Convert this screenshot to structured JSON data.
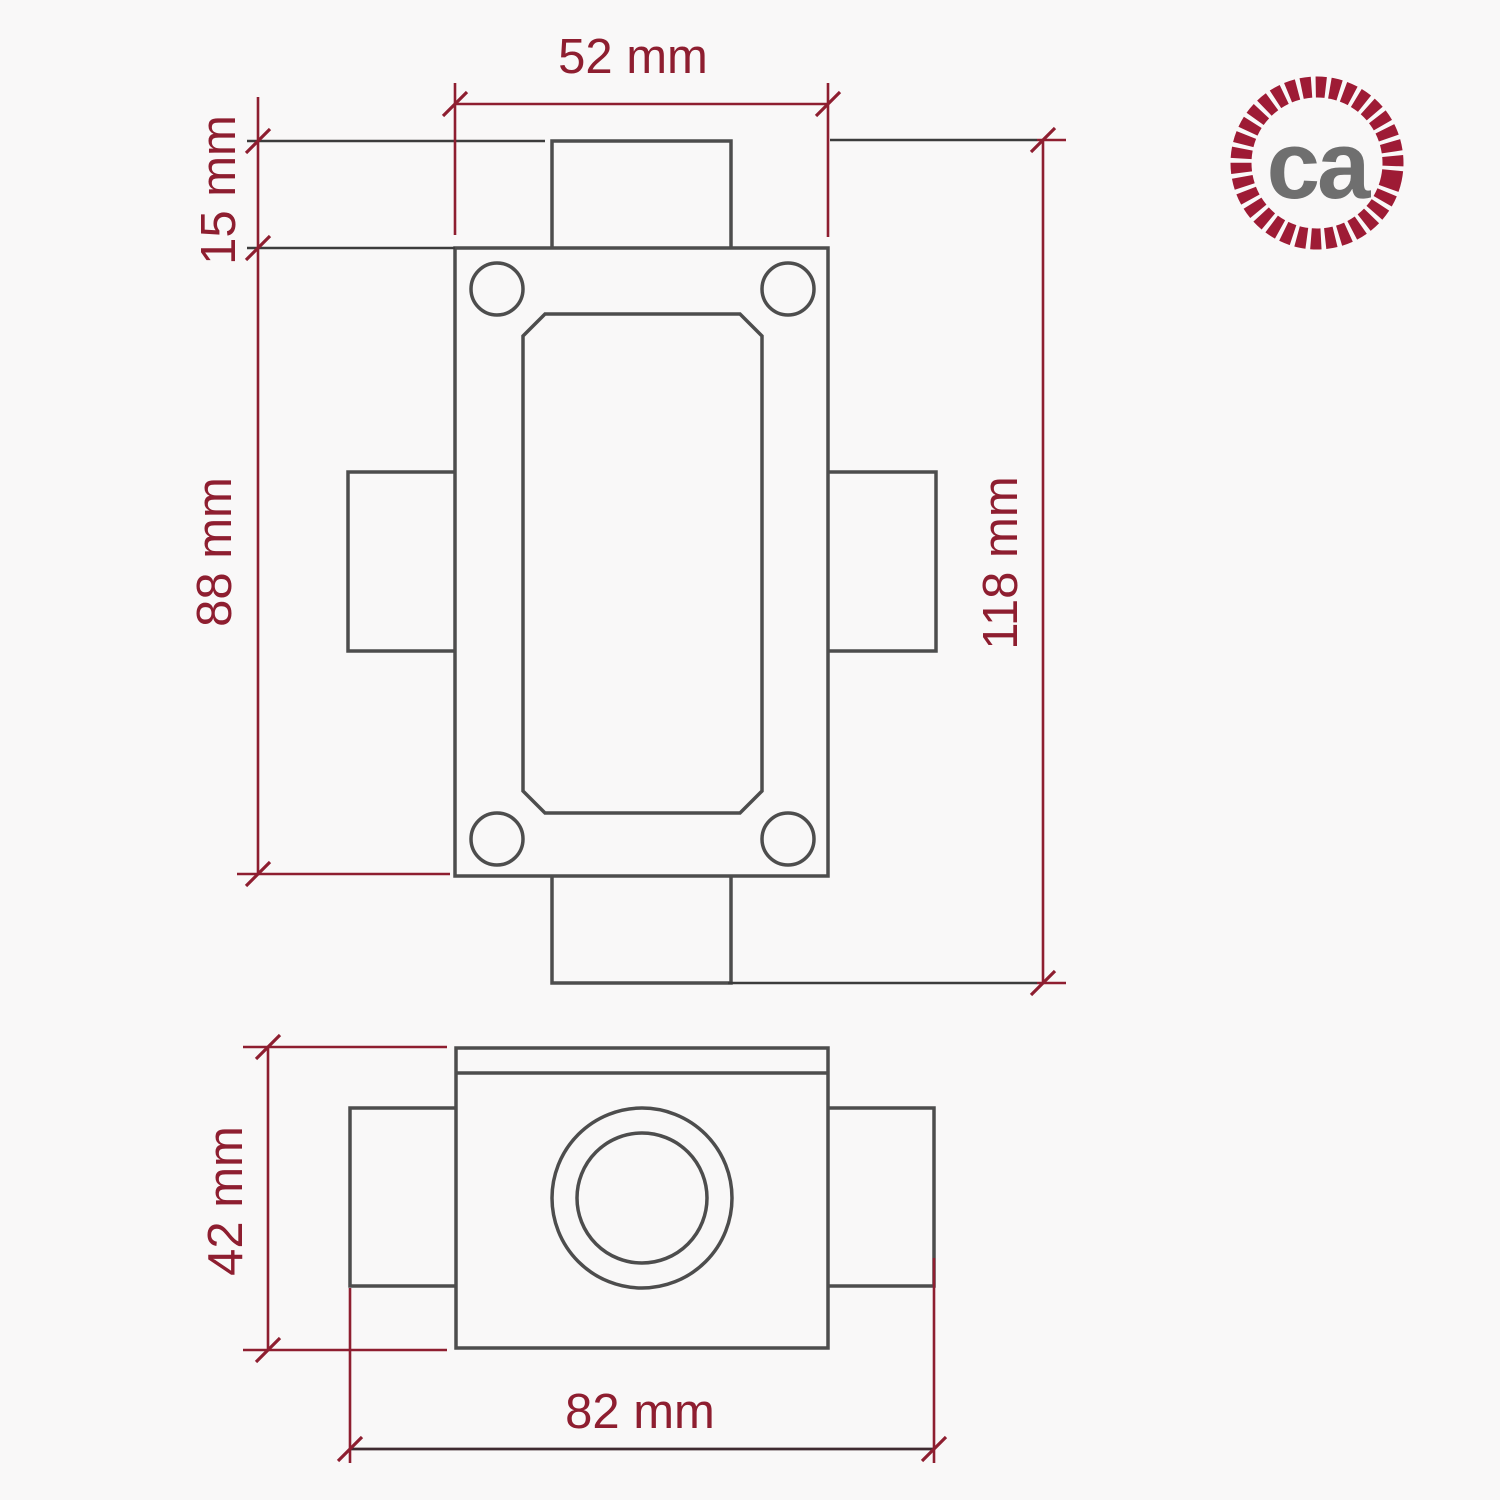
{
  "page": {
    "title": "Junction box dimension drawing",
    "background": "#f9f8f8"
  },
  "logo": {
    "text": "ca",
    "ring_color": "#9e1b35",
    "text_color": "#6f6f6f"
  },
  "colors": {
    "dimension_accent": "#8e1e30",
    "object_line": "#4d4d4d",
    "extension_line": "#3c3c3c"
  },
  "dims": {
    "d52": "52 mm",
    "d15": "15 mm",
    "d88": "88 mm",
    "d118": "118 mm",
    "d42": "42 mm",
    "d82": "82 mm"
  }
}
